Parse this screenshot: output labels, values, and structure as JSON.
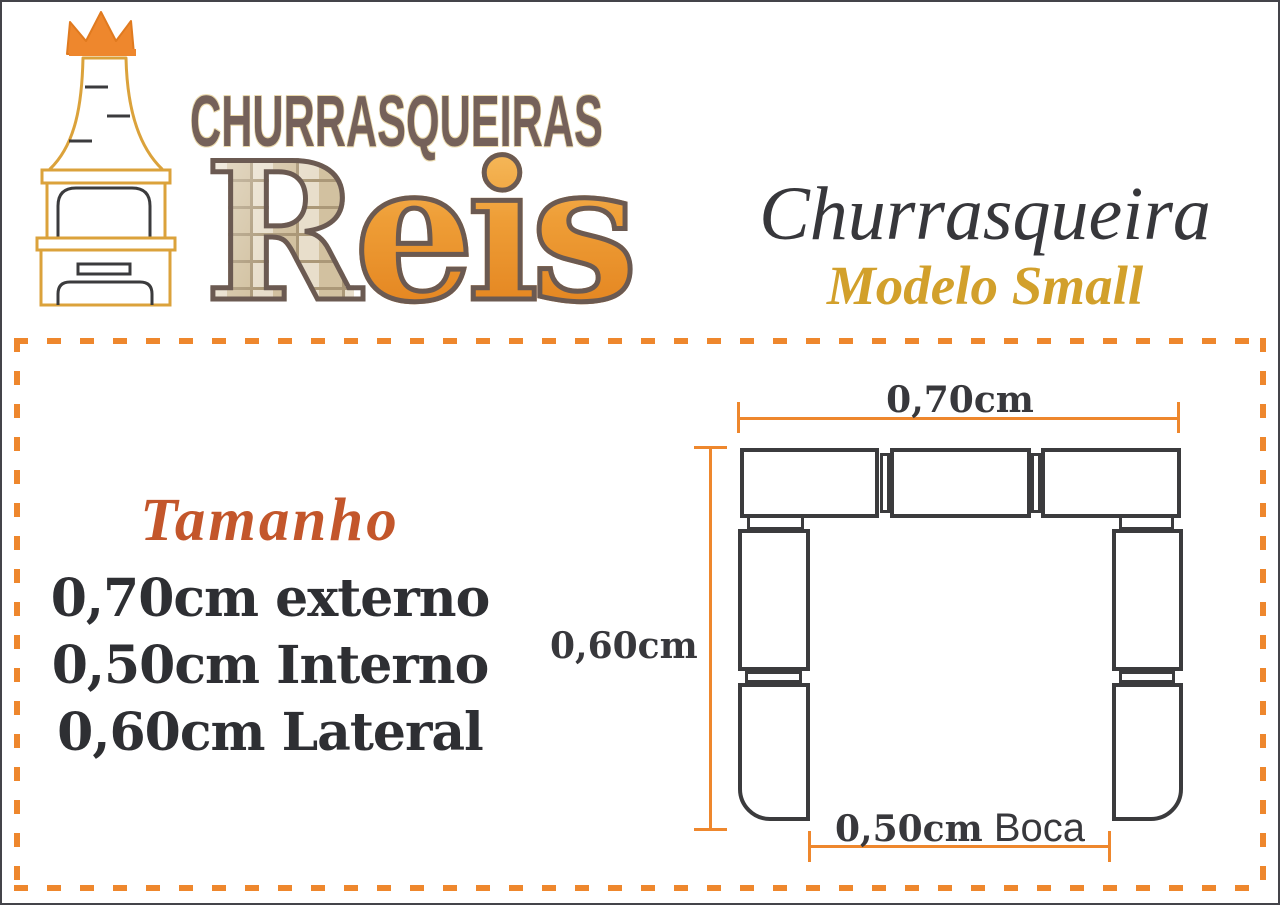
{
  "brand": {
    "top_text": "CHURRASQUEIRAS",
    "name_first_letter": "R",
    "name_rest": "eis"
  },
  "product": {
    "title": "Churrasqueira",
    "subtitle": "Modelo Small"
  },
  "sizes": {
    "heading": "Tamanho",
    "lines": [
      "0,70cm externo",
      "0,50cm Interno",
      "0,60cm Lateral"
    ]
  },
  "diagram": {
    "top_dimension": "0,70cm",
    "side_dimension": "0,60cm",
    "bottom_dimension_value": "0,50cm",
    "bottom_dimension_suffix": " Boca"
  },
  "colors": {
    "accent_orange": "#ee872d",
    "logo_gold": "#dba23b",
    "brand_brown": "#75615a",
    "diagram_dark": "#3b3b3d",
    "title_dark": "#37373b",
    "subtitle_gold": "#d2a02b",
    "heading_orange": "#c3562b",
    "brick_tan": "#ddd0b8",
    "letter_orange": "#ed9a33"
  }
}
